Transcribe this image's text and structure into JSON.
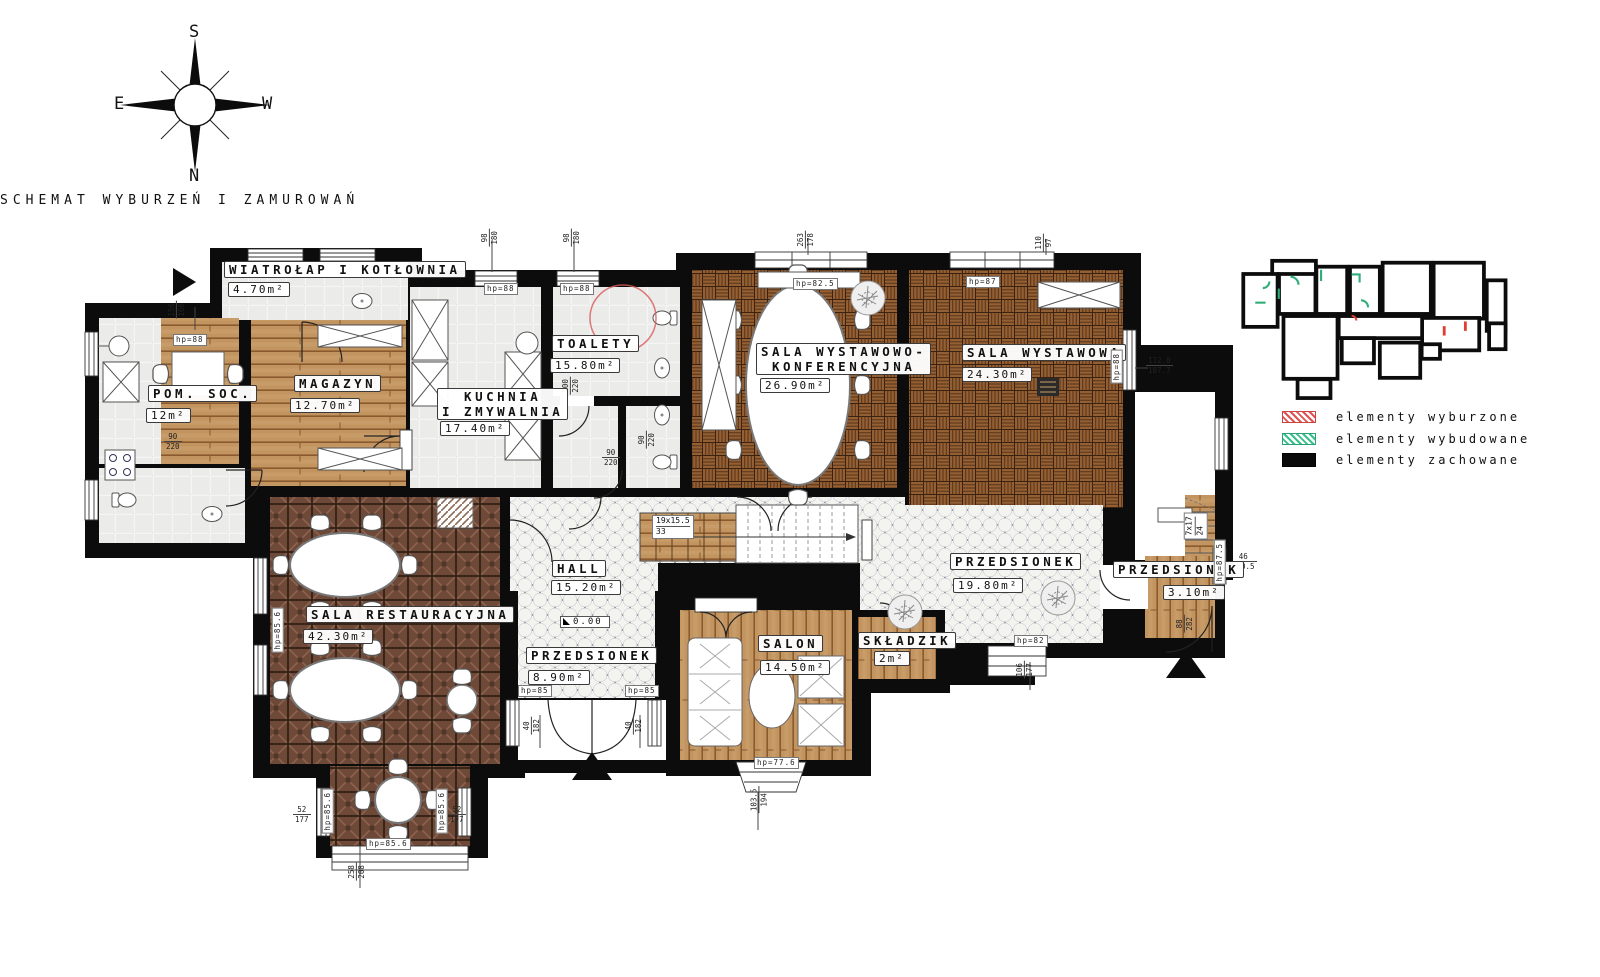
{
  "title": "SCHEMAT WYBURZEŃ I ZAMUROWAŃ",
  "compass": {
    "top": "S",
    "bottom": "N",
    "left": "E",
    "right": "W"
  },
  "legend": [
    {
      "label": "elementy wyburzone",
      "color": "#e05252",
      "style": "red-hatch"
    },
    {
      "label": "elementy wybudowane",
      "color": "#35c08a",
      "style": "green-hatch"
    },
    {
      "label": "elementy zachowane",
      "color": "#0a0a0a",
      "style": "solid-black"
    }
  ],
  "rooms": [
    {
      "name": "WIATROŁAP I KOTŁOWNIA",
      "area": "4.70m²"
    },
    {
      "name": "POM. SOC.",
      "area": "12m²"
    },
    {
      "name": "MAGAZYN",
      "area": "12.70m²"
    },
    {
      "name": "KUCHNIA\nI ZMYWALNIA",
      "area": "17.40m²"
    },
    {
      "name": "TOALETY",
      "area": "15.80m²"
    },
    {
      "name": "SALA WYSTAWOWO-\nKONFERENCYJNA",
      "area": "26.90m²"
    },
    {
      "name": "SALA WYSTAWOWA",
      "area": "24.30m²"
    },
    {
      "name": "SALA RESTAURACYJNA",
      "area": "42.30m²"
    },
    {
      "name": "HALL",
      "area": "15.20m²"
    },
    {
      "name": "PRZEDSIONEK",
      "area": "8.90m²"
    },
    {
      "name": "SALON",
      "area": "14.50m²"
    },
    {
      "name": "SKŁADZIK",
      "area": "2m²"
    },
    {
      "name": "PRZEDSIONEK",
      "area": "19.80m²"
    },
    {
      "name": "PRZEDSIONEK",
      "area": "3.10m²"
    }
  ],
  "hp": [
    "hp=88",
    "hp=88",
    "hp=88",
    "hp=82.5",
    "hp=87",
    "hp=88",
    "hp=85.6",
    "hp=85.6",
    "hp=85.6",
    "hp=85.6",
    "hp=85",
    "hp=85",
    "hp=77.6",
    "hp=82",
    "hp=87.5"
  ],
  "dims": [
    {
      "a": "156",
      "b": "166"
    },
    {
      "a": "98",
      "b": "180"
    },
    {
      "a": "98",
      "b": "180"
    },
    {
      "a": "263",
      "b": "178"
    },
    {
      "a": "110",
      "b": "97"
    },
    {
      "a": "112.8",
      "b": "187.7"
    },
    {
      "a": "46",
      "b": "180.5"
    },
    {
      "a": "90",
      "b": "220"
    },
    {
      "a": "90",
      "b": "220"
    },
    {
      "a": "90",
      "b": "220"
    },
    {
      "a": "100",
      "b": "220"
    },
    {
      "a": "52",
      "b": "177"
    },
    {
      "a": "52",
      "b": "177"
    },
    {
      "a": "258",
      "b": "208"
    },
    {
      "a": "40",
      "b": "182"
    },
    {
      "a": "40",
      "b": "182"
    },
    {
      "a": "103.5",
      "b": "194"
    },
    {
      "a": "106",
      "b": "177"
    },
    {
      "a": "88",
      "b": "282"
    }
  ],
  "stairs": [
    {
      "a": "19x15.5",
      "b": "33"
    },
    {
      "a": "7x17",
      "b": "24"
    }
  ],
  "level": "0.00",
  "colors": {
    "wall": "#0c0c0c",
    "parquet_basket": "#935f33",
    "parquet_diagonal": "#6e4937",
    "wood_plank": "#c2945f",
    "octagon_tile_gap": "#4f5b72",
    "ceramic_tile": "#ebebe9",
    "demolished": "#e03c31",
    "built": "#2fae78"
  }
}
